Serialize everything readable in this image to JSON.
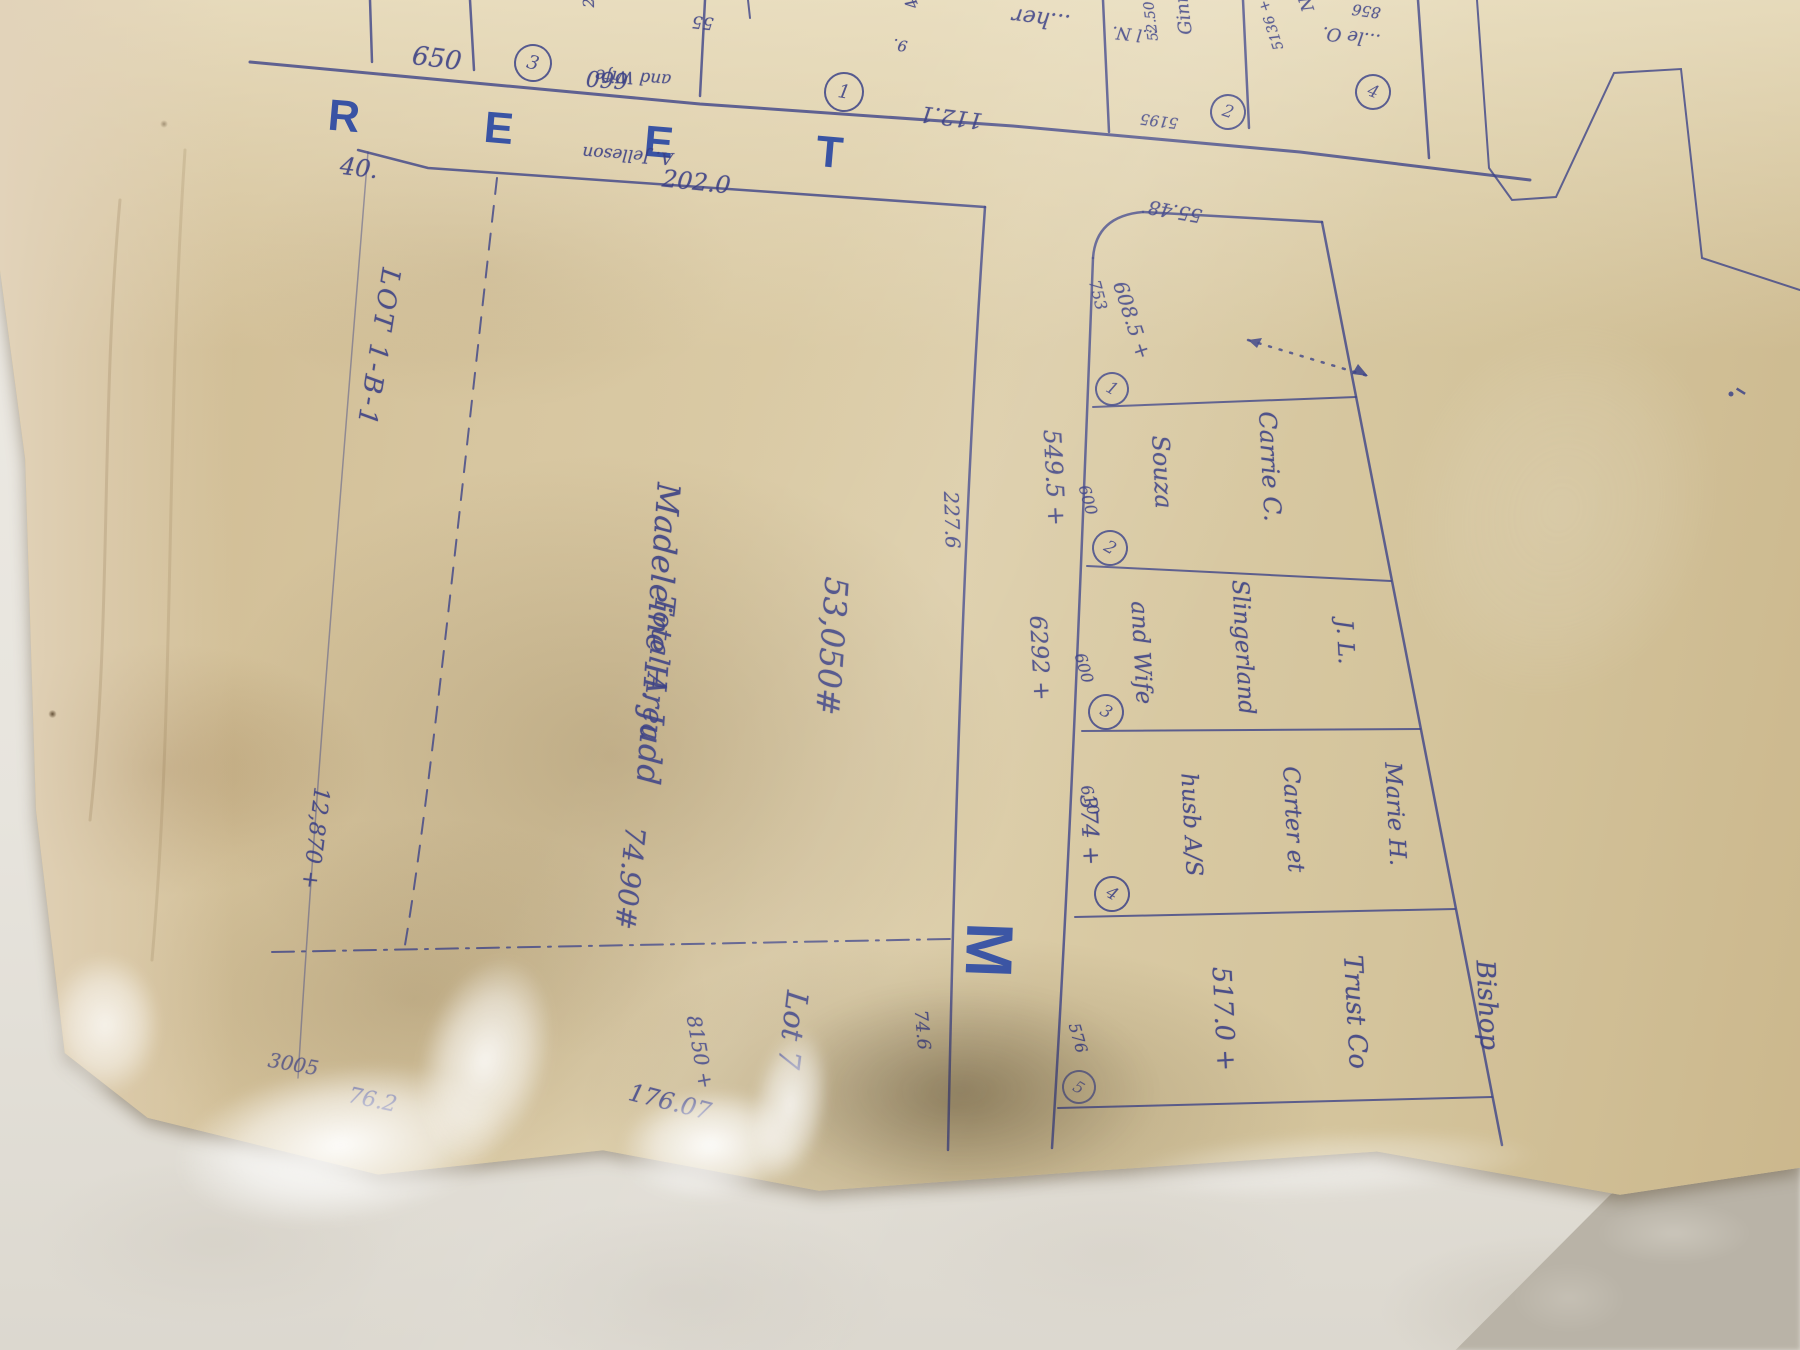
{
  "street": {
    "l1": "R",
    "l2": "E",
    "l3": "E",
    "l4": "T",
    "cross": "M"
  },
  "top_lots": {
    "dim_650": "650",
    "circ_a": "3",
    "jelleson_1": "A. Jelleson",
    "jelleson_2": "and Wife",
    "jelleson_area": "2100 +",
    "dim_660": "660",
    "dim_55": "55",
    "circ_b": "1",
    "dim_112": "112.1",
    "frag_her": "...her",
    "frag_449": "449 +",
    "frag_9": "9.",
    "circ_c": "2",
    "ginns_1": "...l N.",
    "ginns_2": "Ginns",
    "ginns_area": "52.50 +",
    "dim_5195": "5195",
    "circ_d": "4",
    "nud_1": "...le O.",
    "nud_2": "Nudholsky",
    "nud_area": "5136 +",
    "dim_856": "856"
  },
  "judd": {
    "dim_40": "40.",
    "dim_202": "202.0",
    "strip_label": "LOT 1-B-1",
    "strip_area": "12,870 +",
    "area": "53,050#",
    "owner": "Madeleine H. Judd",
    "total_label": "Total Area",
    "total_value": "74.90#",
    "dim_right": "227.6",
    "dim_right_low": "74.6",
    "dim_3005": "3005",
    "dim_762": "76.2",
    "dim_8150": "8150 +",
    "dim_17607": "176.07",
    "lot7": "Lot 7"
  },
  "rcol": {
    "dim_5548": "55.48",
    "l1_a": "753",
    "l1_b": "608.5 +",
    "c1": "1",
    "e2": "600",
    "l2_1": "Carrie C.",
    "l2_2": "Souza",
    "l2_3": "549.5 +",
    "c2": "2",
    "e3": "600",
    "l3_1": "J. L.",
    "l3_2": "Slingerland",
    "l3_3": "and Wife",
    "l3_4": "6292 +",
    "c3": "3",
    "e4": "610",
    "l4_1": "Marie H.",
    "l4_2": "Carter et",
    "l4_3": "husb A/S",
    "l4_4": "374 +",
    "c4": "4",
    "e5": "576",
    "l5_1": "Bishop",
    "l5_2": "Trust Co",
    "l5_3": "517.0 +",
    "c5": "5"
  }
}
